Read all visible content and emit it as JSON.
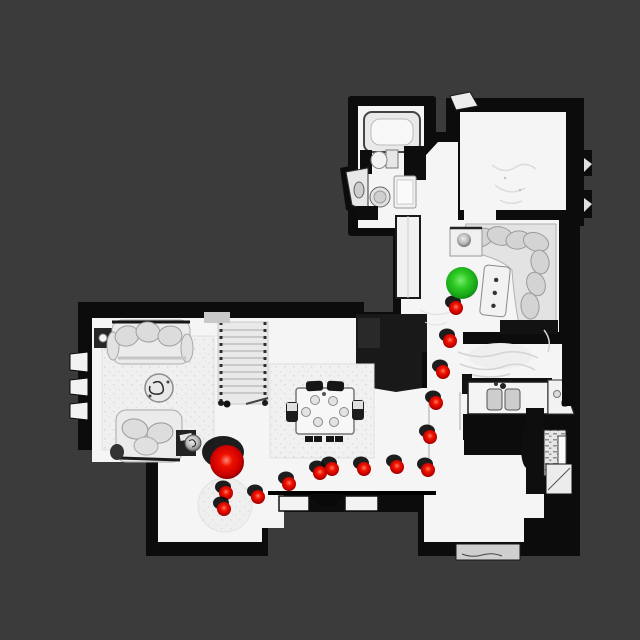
{
  "canvas": {
    "width": 640,
    "height": 640
  },
  "colors": {
    "background": "#3b3b3b",
    "floor": "#f5f5f5",
    "wall": "#0c0c0c",
    "furniture": "#dcdcdc",
    "path_red": "#e10600",
    "goal_green": "#22c32a",
    "decor_gray": "#b5b5b5"
  },
  "markers": {
    "start": {
      "x": 227,
      "y": 462,
      "r": 17,
      "color": "#e10600"
    },
    "goal": {
      "x": 462,
      "y": 283,
      "r": 16,
      "color": "#22c32a"
    },
    "decor_ball": {
      "x": 464,
      "y": 240,
      "r": 7,
      "color": "#b5b5b5"
    }
  },
  "path": {
    "dot_radius": 7,
    "color": "#e10600",
    "waypoints": [
      {
        "x": 456,
        "y": 308
      },
      {
        "x": 450,
        "y": 341
      },
      {
        "x": 443,
        "y": 372
      },
      {
        "x": 436,
        "y": 403
      },
      {
        "x": 430,
        "y": 437
      },
      {
        "x": 428,
        "y": 470
      },
      {
        "x": 397,
        "y": 467
      },
      {
        "x": 364,
        "y": 469
      },
      {
        "x": 332,
        "y": 469
      },
      {
        "x": 320,
        "y": 473
      },
      {
        "x": 289,
        "y": 484
      },
      {
        "x": 258,
        "y": 497
      },
      {
        "x": 226,
        "y": 493
      },
      {
        "x": 224,
        "y": 509
      }
    ]
  }
}
